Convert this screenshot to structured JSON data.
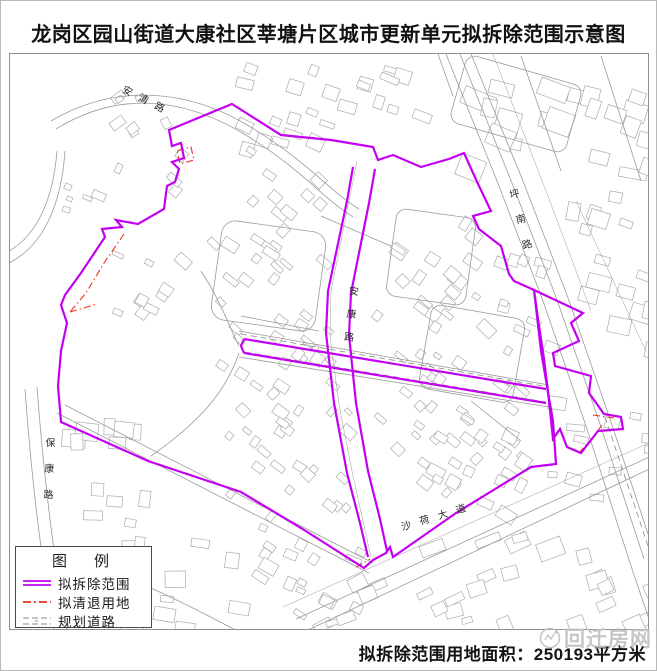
{
  "title": "龙岗区园山街道大康社区莘塘片区城市更新单元拟拆除范围示意图",
  "legend": {
    "title": "图　例",
    "items": [
      {
        "id": "demolition",
        "label": "拟拆除范围"
      },
      {
        "id": "clearance",
        "label": "拟清退用地"
      },
      {
        "id": "planned_road",
        "label": "规划道路"
      }
    ]
  },
  "map": {
    "road_labels": [
      {
        "id": "anqing-road",
        "name": "安清路"
      },
      {
        "id": "pingnan-road",
        "name": "坪南路"
      },
      {
        "id": "ankang-road",
        "name": "安康路"
      },
      {
        "id": "baokang-road",
        "name": "保康路"
      },
      {
        "id": "shahe-avenue",
        "name": "沙荷大道"
      }
    ]
  },
  "footer": {
    "area_text": "拟拆除范围用地面积：250193平方米"
  },
  "watermark": {
    "text": "回迁房网"
  },
  "colors": {
    "demolition": "#c400f2",
    "clearance": "#f03020",
    "linework": "#9a9a9a",
    "planned": "#8a8a8a"
  }
}
